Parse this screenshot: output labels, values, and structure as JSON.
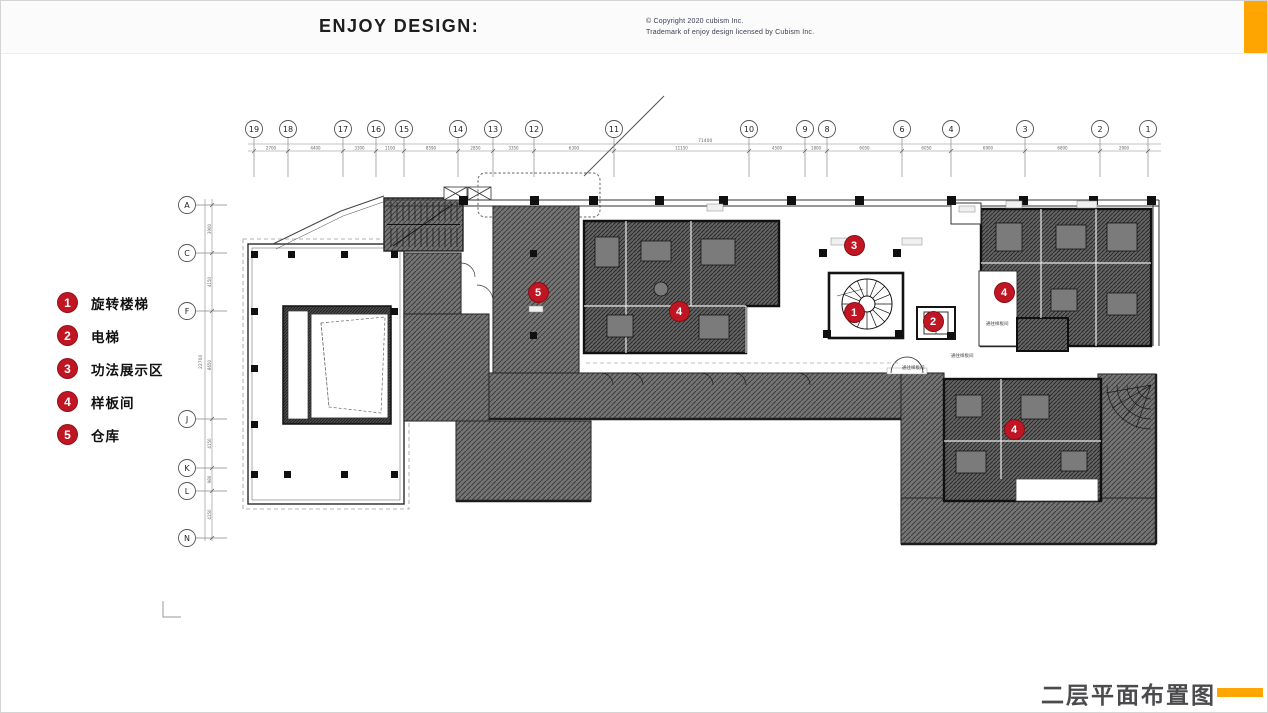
{
  "colors": {
    "accent": "#FFA502",
    "marker": "#c01522",
    "title": "#4b4b4e"
  },
  "header": {
    "brand": "ENJOY DESIGN:",
    "copyright_line1": "©   Copyright 2020 cubism Inc.",
    "copyright_line2": "Trademark of enjoy design licensed by Cubism Inc."
  },
  "footer": {
    "title": "二层平面布置图"
  },
  "legend": {
    "items": [
      {
        "num": "1",
        "label": "旋转楼梯"
      },
      {
        "num": "2",
        "label": "电梯"
      },
      {
        "num": "3",
        "label": "功法展示区"
      },
      {
        "num": "4",
        "label": "样板间"
      },
      {
        "num": "5",
        "label": "仓库"
      }
    ]
  },
  "plan": {
    "markers": [
      {
        "num": "1",
        "x": 853,
        "y": 311
      },
      {
        "num": "2",
        "x": 932,
        "y": 320
      },
      {
        "num": "3",
        "x": 853,
        "y": 244
      },
      {
        "num": "4",
        "x": 678,
        "y": 310
      },
      {
        "num": "4",
        "x": 1003,
        "y": 291
      },
      {
        "num": "4",
        "x": 1013,
        "y": 428
      },
      {
        "num": "5",
        "x": 537,
        "y": 291
      }
    ],
    "top_axis": {
      "total": "71400",
      "cols": [
        {
          "label": "19",
          "x": 253
        },
        {
          "label": "18",
          "x": 287
        },
        {
          "label": "17",
          "x": 342
        },
        {
          "label": "16",
          "x": 375
        },
        {
          "label": "15",
          "x": 403
        },
        {
          "label": "14",
          "x": 457
        },
        {
          "label": "13",
          "x": 492
        },
        {
          "label": "12",
          "x": 533
        },
        {
          "label": "11",
          "x": 613
        },
        {
          "label": "10",
          "x": 748
        },
        {
          "label": "9",
          "x": 804
        },
        {
          "label": "8",
          "x": 826
        },
        {
          "label": "6",
          "x": 901
        },
        {
          "label": "4",
          "x": 950
        },
        {
          "label": "3",
          "x": 1024
        },
        {
          "label": "2",
          "x": 1099
        },
        {
          "label": "1",
          "x": 1147
        }
      ],
      "dims": [
        "2700",
        "4400",
        "3300",
        "1100",
        "8590",
        "2850",
        "3350",
        "6300",
        "11150",
        "4500",
        "1800",
        "6050",
        "6050",
        "6900",
        "6800",
        "2900"
      ]
    },
    "left_axis": {
      "total": "22700",
      "rows": [
        {
          "label": "A",
          "y": 204
        },
        {
          "label": "C",
          "y": 252
        },
        {
          "label": "F",
          "y": 310
        },
        {
          "label": "J",
          "y": 418
        },
        {
          "label": "K",
          "y": 467
        },
        {
          "label": "L",
          "y": 490
        },
        {
          "label": "N",
          "y": 537
        }
      ],
      "dims": [
        "3900",
        "4150",
        "8650",
        "4150",
        "980",
        "4150"
      ]
    },
    "small_labels": [
      {
        "text": "通往样板间",
        "x": 985,
        "y": 324
      },
      {
        "text": "通往样板间",
        "x": 950,
        "y": 356
      },
      {
        "text": "通往样板间",
        "x": 901,
        "y": 368
      }
    ]
  }
}
